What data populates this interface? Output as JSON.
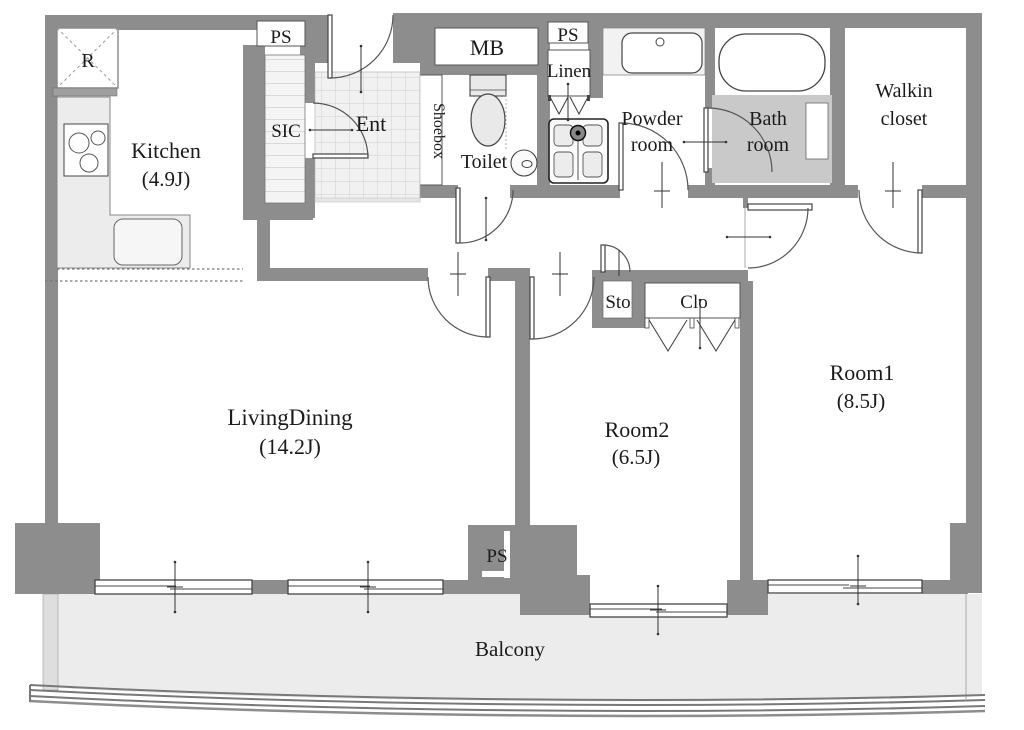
{
  "plan_type": "apartment-floor-plan",
  "labels": {
    "r": "R",
    "ps_top": "PS",
    "sic": "SIC",
    "ent": "Ent",
    "shoebox": "Shoebox",
    "mb": "MB",
    "ps_mid": "PS",
    "linen": "Linen",
    "toilet": "Toilet",
    "powder_1": "Powder",
    "powder_2": "room",
    "bath_1": "Bath",
    "bath_2": "room",
    "walkin_1": "Walkin",
    "walkin_2": "closet",
    "kitchen_1": "Kitchen",
    "kitchen_2": "(4.9J)",
    "living_1": "LivingDining",
    "living_2": "(14.2J)",
    "room2_1": "Room2",
    "room2_2": "(6.5J)",
    "room1_1": "Room1",
    "room1_2": "(8.5J)",
    "sto": "Sto",
    "clo": "Clo",
    "ps_bottom": "PS",
    "balcony": "Balcony"
  },
  "rooms": [
    {
      "name": "Kitchen",
      "size": "(4.9J)"
    },
    {
      "name": "LivingDining",
      "size": "(14.2J)"
    },
    {
      "name": "Room1",
      "size": "(8.5J)"
    },
    {
      "name": "Room2",
      "size": "(6.5J)"
    },
    {
      "name": "Walkin closet"
    },
    {
      "name": "Powder room"
    },
    {
      "name": "Bath room"
    },
    {
      "name": "Toilet"
    },
    {
      "name": "Ent"
    },
    {
      "name": "Balcony"
    }
  ],
  "colors": {
    "wall": "#8d8d8d",
    "floor": "#ffffff",
    "balcony_floor": "#ececec",
    "bath_floor": "#c9c9c9",
    "counter": "#ececec",
    "line": "#444444",
    "text": "#1b1b1b"
  }
}
